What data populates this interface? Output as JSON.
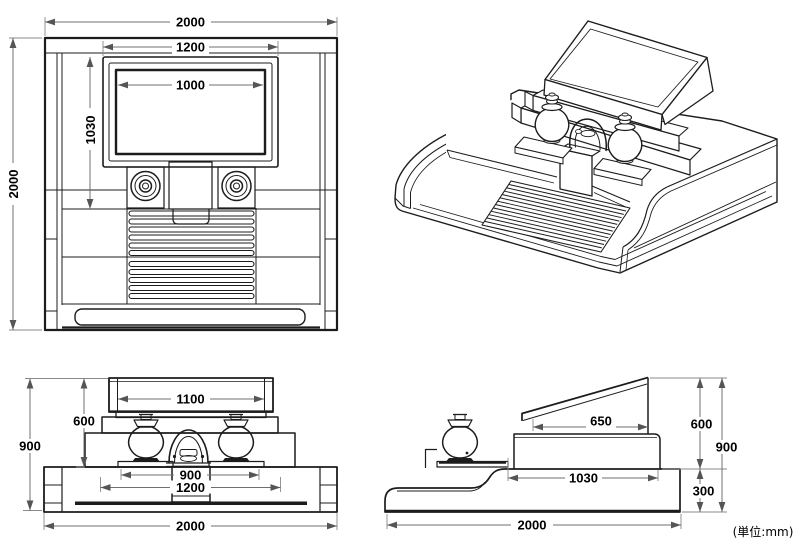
{
  "unit_label": "(単位:mm)",
  "plan_view": {
    "overall_width": "2000",
    "overall_depth": "2000",
    "monument_width": "1200",
    "inner_width": "1000",
    "monument_depth": "1030"
  },
  "front_view": {
    "headstone_width": "1100",
    "upper_height": "600",
    "total_height": "900",
    "altar_width": "900",
    "base_tier_width": "1200",
    "overall_width": "2000"
  },
  "side_view": {
    "top_depth": "650",
    "upper_height": "600",
    "total_height": "900",
    "platform_depth": "1030",
    "base_height": "300",
    "overall_depth": "2000"
  }
}
